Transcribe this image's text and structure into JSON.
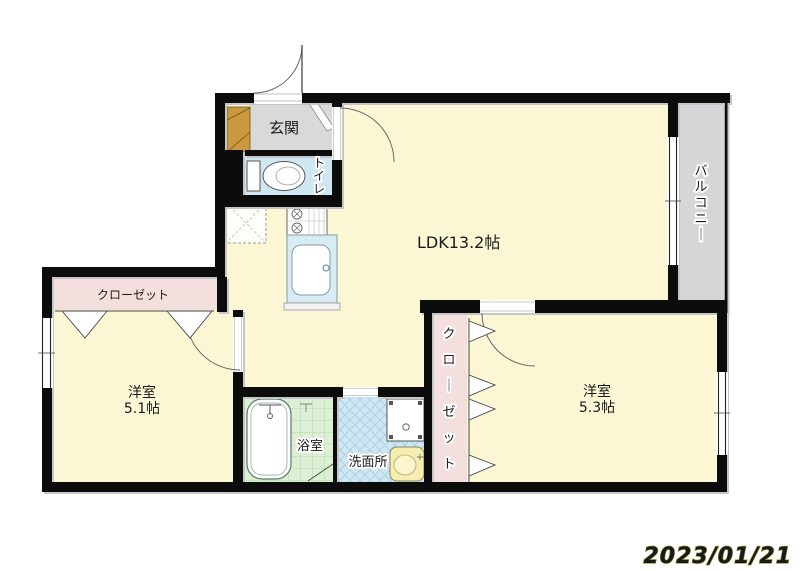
{
  "plan": {
    "entrance": {
      "label": "玄関"
    },
    "toilet": {
      "label": "トイレ"
    },
    "ldk": {
      "label": "LDK13.2帖"
    },
    "balcony": {
      "label": "バルコニー"
    },
    "closet_left": {
      "label": "クローゼット"
    },
    "closet_right": {
      "label": "クローゼット"
    },
    "bedroom_left": {
      "name": "洋室",
      "size": "5.1帖"
    },
    "bedroom_right": {
      "name": "洋室",
      "size": "5.3帖"
    },
    "bathroom": {
      "label": "浴室"
    },
    "washroom": {
      "label": "洗面所"
    },
    "date": "2023/01/21",
    "colors": {
      "room_yellow": "#fbf7d4",
      "closet_pink": "#f3dfdd",
      "wet_blue": "#cfe7f3",
      "bath_green": "#ddefd5",
      "entry_gray": "#d9d9d9",
      "balcony_gray": "#d6d6d8",
      "cabinet_tan": "#c9983f",
      "counter_blue": "#d9ecf4",
      "basin_yellow": "#f6edaf",
      "date_yellow": "#f0ee3c",
      "wall_black": "#0c0c0c"
    }
  }
}
